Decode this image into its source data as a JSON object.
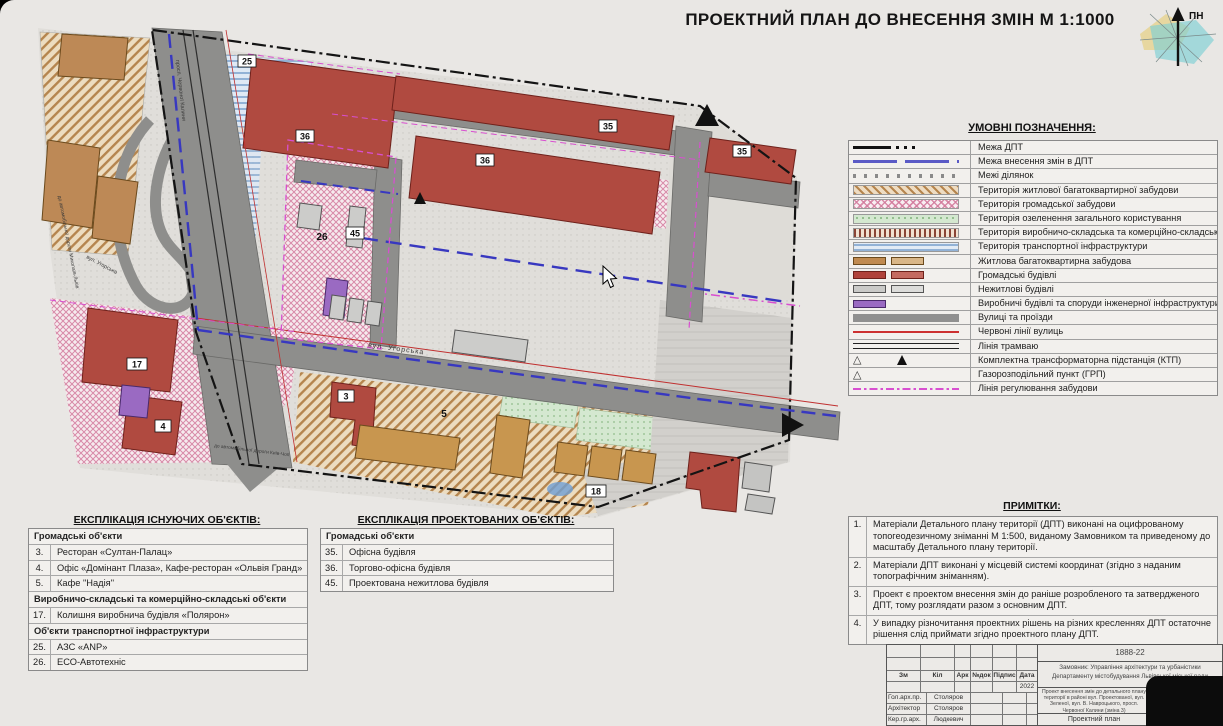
{
  "header": {
    "title": "ПРОЕКТНИЙ ПЛАН ДО ВНЕСЕННЯ ЗМІН М 1:1000"
  },
  "north_arrow": {
    "label": "ПН"
  },
  "legend": {
    "title": "УМОВНІ ПОЗНАЧЕННЯ:",
    "items": [
      "Межа  ДПТ",
      "Межа  внесення змін в ДПТ",
      "Межі  ділянок",
      "Територія житлової багатоквартирної забудови",
      "Територія громадської забудови",
      "Територія озеленення загального користування",
      "Територія виробничо-складська та комерційно-складська",
      "Територія транспортної інфраструктури",
      "Житлова багатоквартирна забудова",
      "Громадські будівлі",
      "Нежитлові будівлі",
      "Виробничі будівлі та споруди інженерної інфраструктури",
      "Вулиці та проїзди",
      "Червоні лінії вулиць",
      "Лінія трамваю",
      "Комплектна трансформаторна підстанція (КТП)",
      "Газорозподільний пункт (ГРП)",
      "Лінія регулювання забудови"
    ]
  },
  "map": {
    "numbers": {
      "n25": "25",
      "n35a": "35",
      "n35b": "35",
      "n36a": "36",
      "n36b": "36",
      "n26": "26",
      "n45": "45",
      "n3": "3",
      "n5": "5",
      "n17": "17",
      "n4": "4",
      "n18": "18"
    },
    "streets": {
      "uhorska": "вул. Угорська",
      "uhorska2": "вул. Угорська",
      "kalyny": "просп. Червоної Калини",
      "west": "до автомобільної дороги Миколаїв-Львів",
      "south": "до автомобільної дороги Київ-Чоп"
    }
  },
  "explication_existing": {
    "title": "ЕКСПЛІКАЦІЯ ІСНУЮЧИХ ОБ'ЄКТІВ:",
    "rows": [
      {
        "text": "Громадські об'єкти"
      },
      {
        "num": "3.",
        "text": "Ресторан «Султан-Палац»"
      },
      {
        "num": "4.",
        "text": "Офіс «Домінант Плаза», Кафе-ресторан «Ольвія Гранд»"
      },
      {
        "num": "5.",
        "text": "Кафе \"Надія\""
      },
      {
        "text": "Виробничо-складські та комерційно-складські об'єкти"
      },
      {
        "num": "17.",
        "text": "Колишня виробнича будівля «Полярон»"
      },
      {
        "text": "Об'єкти транспортної інфраструктури"
      },
      {
        "num": "25.",
        "text": "АЗС «ANP»"
      },
      {
        "num": "26.",
        "text": "ЕСО-Автотехніс"
      }
    ]
  },
  "explication_projected": {
    "title": "ЕКСПЛІКАЦІЯ ПРОЕКТОВАНИХ ОБ'ЄКТІВ:",
    "rows": [
      {
        "text": "Громадські об'єкти"
      },
      {
        "num": "35.",
        "text": "Офісна будівля"
      },
      {
        "num": "36.",
        "text": "Торгово-офісна будівля"
      },
      {
        "num": "45.",
        "text": "Проектована нежитлова будівля"
      }
    ]
  },
  "notes": {
    "title": "ПРИМІТКИ:",
    "items": [
      {
        "num": "1.",
        "text": "Матеріали Детального плану території (ДПТ) виконані на оцифрованому топогеодезичному зніманні М 1:500,  виданому Замовником та приведеному до масштабу Детального плану території."
      },
      {
        "num": "2.",
        "text": "Матеріали ДПТ виконані у місцевій системі координат (згідно з наданим топографічним зніманням)."
      },
      {
        "num": "3.",
        "text": "Проект є проектом внесення змін до раніше розробленого та затвердженого ДПТ,  тому  розглядати разом з основним ДПТ."
      },
      {
        "num": "4.",
        "text": "У випадку різночитання проектних рішень на різних кресленнях ДПТ остаточне рішення слід приймати згідно проектного плану ДПТ."
      }
    ]
  },
  "title_block": {
    "code": "1888-22",
    "client": "Замовник: Управління архітектури та урбаністики Департаменту містобудування Львівської міської ради",
    "cols": [
      "Зм",
      "Кіл",
      "Арк",
      "№док",
      "Підпис",
      "Дата"
    ],
    "date": "2022",
    "signatures": [
      {
        "role": "Гол.арх.пр.",
        "name": "Столяров"
      },
      {
        "role": "Архітектор",
        "name": "Столяров"
      },
      {
        "role": "Кер.гр.арх.",
        "name": "Людкевич"
      }
    ],
    "project": "Проект внесення змін до детального плану території в районі вул. Проектованої, вул. Зеленої, вул. В. Навроцького, просп. Червоної Калини (зміна 3)",
    "stage_label": "Стадія",
    "sheet_label": "Аркуш",
    "sheets_label": "Аркушів",
    "stage": "ДПТ",
    "doc_name": "Проектний план"
  }
}
